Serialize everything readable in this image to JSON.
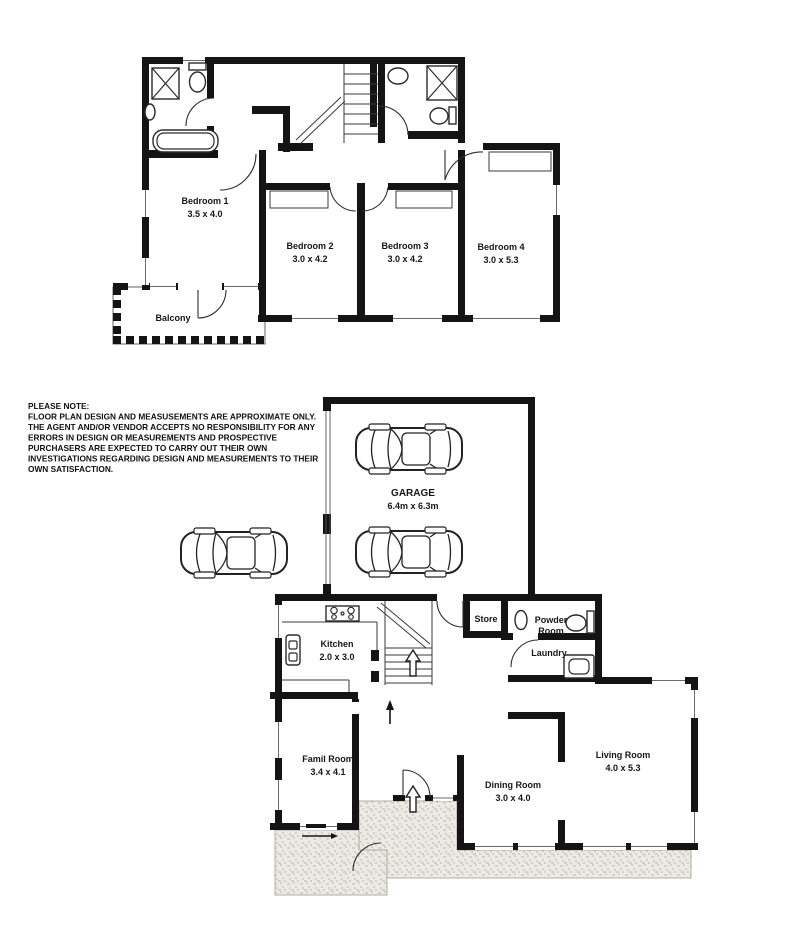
{
  "note": {
    "heading": "PLEASE NOTE:",
    "lines": [
      "FLOOR PLAN DESIGN AND MEASUSEMENTS ARE APPROXIMATE ONLY.",
      "THE AGENT AND/OR VENDOR ACCEPTS NO RESPONSIBILITY FOR ANY",
      "ERRORS IN DESIGN OR MEASUREMENTS AND  PROSPECTIVE",
      "PURCHASERS ARE EXPECTED TO CARRY OUT THEIR OWN",
      "INVESTIGATIONS REGARDING DESIGN AND MEASUREMENTS TO THEIR",
      "OWN SATISFACTION."
    ]
  },
  "upper_floor": {
    "bedroom1": {
      "name": "Bedroom 1",
      "dims": "3.5 x 4.0"
    },
    "bedroom2": {
      "name": "Bedroom 2",
      "dims": "3.0 x 4.2"
    },
    "bedroom3": {
      "name": "Bedroom 3",
      "dims": "3.0 x 4.2"
    },
    "bedroom4": {
      "name": "Bedroom 4",
      "dims": "3.0 x 5.3"
    },
    "balcony": {
      "name": "Balcony"
    }
  },
  "ground_floor": {
    "garage": {
      "name": "GARAGE",
      "dims": "6.4m x 6.3m"
    },
    "kitchen": {
      "name": "Kitchen",
      "dims": "2.0 x 3.0"
    },
    "store": {
      "name": "Store"
    },
    "powder_room": {
      "line1": "Powder",
      "line2": "Room"
    },
    "laundry": {
      "name": "Laundry"
    },
    "family_room": {
      "name": "Famil Room",
      "dims": "3.4 x 4.1"
    },
    "dining_room": {
      "name": "Dining Room",
      "dims": "3.0 x 4.0"
    },
    "living_room": {
      "name": "Living Room",
      "dims": "4.0 x 5.3"
    }
  },
  "colors": {
    "wall": "#141414",
    "background": "#ffffff",
    "paving_bg": "#eceae4",
    "paving_dot": "#b9b5ab"
  }
}
